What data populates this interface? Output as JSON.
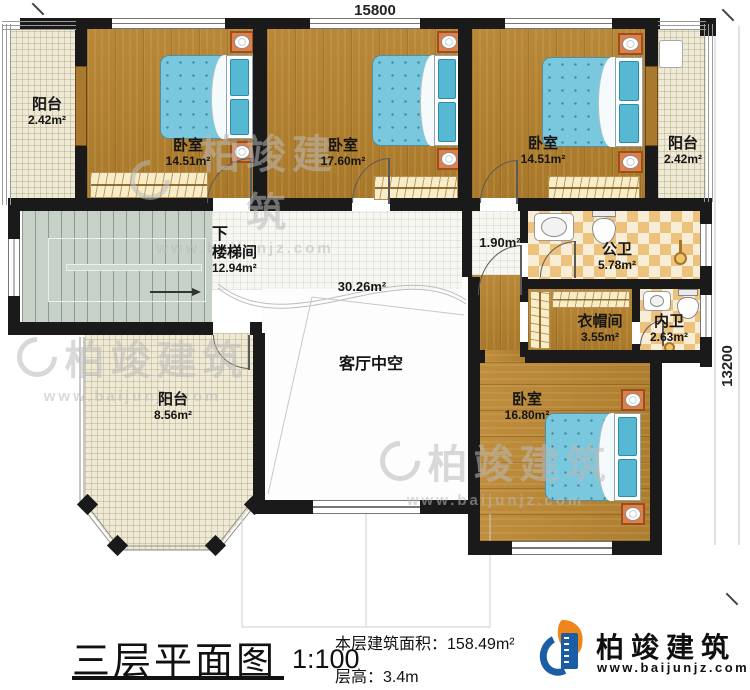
{
  "dimensions": {
    "top": "15800",
    "right": "13200"
  },
  "rooms": {
    "balcony_tl": {
      "name": "阳台",
      "area": "2.42m²"
    },
    "bedroom1": {
      "name": "卧室",
      "area": "14.51m²"
    },
    "bedroom2": {
      "name": "卧室",
      "area": "17.60m²"
    },
    "bedroom3": {
      "name": "卧室",
      "area": "14.51m²"
    },
    "balcony_tr": {
      "name": "阳台",
      "area": "2.42m²"
    },
    "stairwell": {
      "name": "楼梯间",
      "area": "12.94m²",
      "direction": "下"
    },
    "corridor": {
      "area": "30.26m²"
    },
    "vestibule": {
      "area": "1.90m²"
    },
    "bath_public": {
      "name": "公卫",
      "area": "5.78m²"
    },
    "cloakroom": {
      "name": "衣帽间",
      "area": "3.55m²"
    },
    "bath_inner": {
      "name": "内卫",
      "area": "2.63m²"
    },
    "balcony_bl": {
      "name": "阳台",
      "area": "8.56m²"
    },
    "living_void": {
      "name": "客厅中空"
    },
    "bedroom4": {
      "name": "卧室",
      "area": "16.80m²"
    }
  },
  "footer": {
    "title": "三层平面图",
    "scale": "1:100",
    "area_label": "本层建筑面积：",
    "area_value": "158.49m²",
    "height_label": "层高：",
    "height_value": "3.4m"
  },
  "brand": {
    "name": "柏竣建筑",
    "site": "www.baijunjz.com"
  },
  "watermark": {
    "name": "柏竣建筑",
    "site": "www.baijunjz.com"
  },
  "colors": {
    "wall": "#1a1a1a",
    "wood": "#b5812d",
    "tile": "#efead6",
    "bed_blue": "#79c8de",
    "checker_tan": "#ecc27c",
    "stair_gray": "#c8d1c8",
    "brand_blue": "#1b5ea6",
    "brand_orange": "#f08519"
  }
}
